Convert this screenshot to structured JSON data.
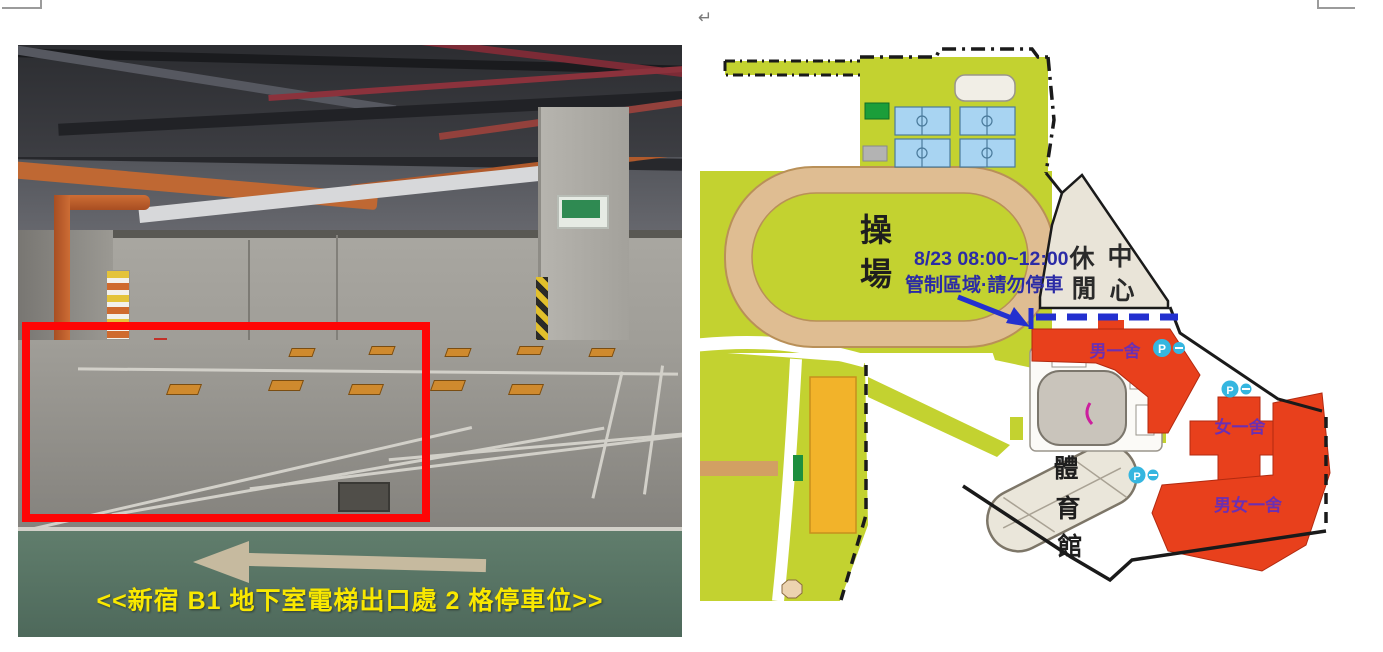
{
  "document": {
    "return_mark": "↵"
  },
  "left_figure": {
    "type": "photo",
    "caption": "<<新宿 B1 地下室電梯出口處 2 格停車位>>",
    "caption_color": "#f9e800",
    "highlight_box_color": "#fe0505"
  },
  "map": {
    "labels": {
      "playground_char1": "操",
      "playground_char2": "場",
      "leisure_char1": "休",
      "leisure_char2": "閒",
      "leisure_char3": "中",
      "leisure_char4": "心",
      "gym_char1": "體",
      "gym_char2": "育",
      "gym_char3": "館",
      "dorm_male_1": "男一舍",
      "dorm_female_1": "女一舍",
      "dorm_male_female_1": "男女一舍",
      "notice_line1": "8/23 08:00~12:00",
      "notice_line2": "管制區域·請勿停車",
      "parking_mark": "P"
    },
    "colors": {
      "campus_green": "#c3d230",
      "track_tan": "#dfbd92",
      "court_blue": "#a8d4f2",
      "building_red": "#e8401c",
      "leisure_beige": "#e9e4d8",
      "gym_beige": "#eae6da",
      "notice_text_blue": "#2b2ba6",
      "restriction_blue": "#2330cf",
      "dorm_label_purple": "#6b2fb3",
      "parking_cyan": "#35b6e0"
    }
  }
}
